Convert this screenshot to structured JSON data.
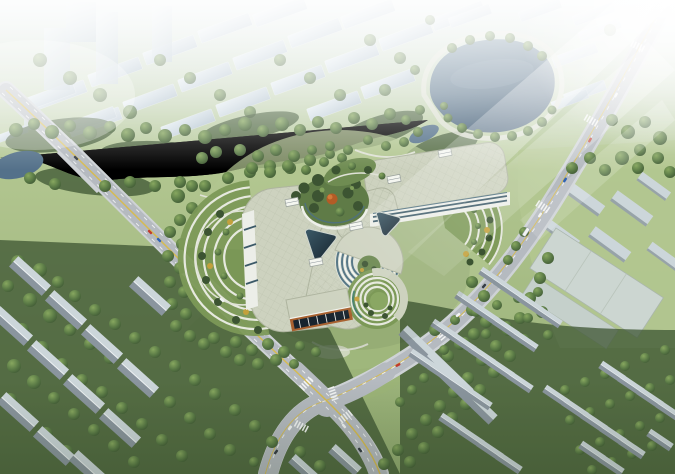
{
  "scene": {
    "setting": "aerial-architectural-rendering",
    "landmarks": [
      "hazy-city-skyline-north",
      "circular-lake",
      "winding-canal",
      "riverside-forest",
      "tri-lobe-hospital-complex",
      "west-terraced-garden-wing",
      "east-terraced-garden-wing",
      "central-courtyard-garden",
      "ring-atrium-court",
      "amphitheater-garden-court",
      "triangular-glass-atriums",
      "entrance-pavilion-brick-glass",
      "diagonal-avenue-northeast",
      "diagonal-avenue-northwest",
      "four-way-intersection",
      "residential-rows-southwest",
      "residential-rows-southeast",
      "campus-warehouse-east",
      "sun-beams-from-upper-right"
    ]
  },
  "palette": {
    "haze": "#dfe9ec",
    "grass": "#93ac72",
    "grass-pale": "#b2c690",
    "lawn": "#7c9957",
    "tree-dark": "#3c5432",
    "tree-mid": "#5a7a46",
    "tree-light": "#87a75f",
    "autumn": "#c2a03c",
    "orange-tree": "#b35c26",
    "water": "#54718a",
    "water-hi": "#7e98ac",
    "lake-hi": "#6f8ba0",
    "lake-lo": "#455f77",
    "road": "#b5bac0",
    "road-edge": "#ced2d6",
    "line-yellow": "#d9bb45",
    "line-white": "#f4f6f6",
    "roof": "#cdd2bf",
    "roof-edge": "#aeb49f",
    "facade": "#eceee8",
    "glass": "#3c5a68",
    "glass-dark": "#17242e",
    "glass-teal": "#4e7080",
    "brick": "#a8612f",
    "slab-hi": "#e3ecf1",
    "slab-lo": "#b4c4d0",
    "res-lit": "#ccd6da",
    "res-dark": "#8a959e",
    "terrace": "#e6e9de",
    "warehouse": "#ccd6d1",
    "path": "#dfe2d6",
    "car-red": "#c03a2e",
    "car-blue": "#2f62b5",
    "car-white": "#f2f4f4",
    "car-dark": "#343c44"
  }
}
